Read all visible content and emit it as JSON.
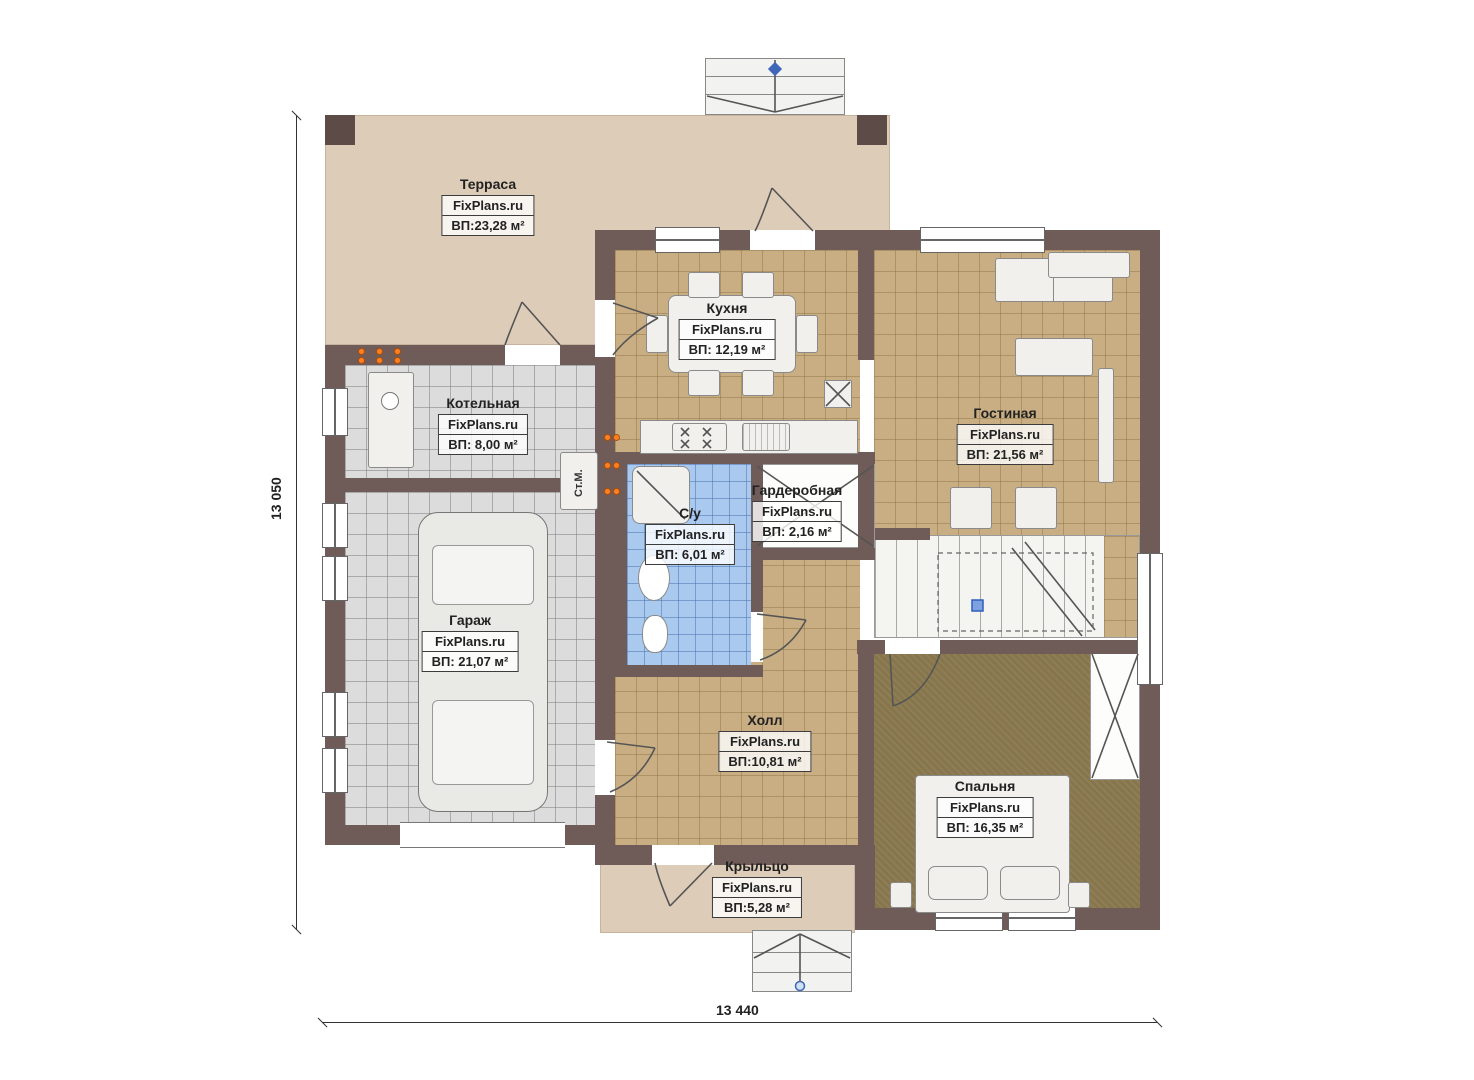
{
  "dims": {
    "height_label": "13 050",
    "width_label": "13 440"
  },
  "rooms": {
    "terrace": {
      "name": "Терраса",
      "brand": "FixPlans.ru",
      "area": "ВП:23,28 м²"
    },
    "kitchen": {
      "name": "Кухня",
      "brand": "FixPlans.ru",
      "area": "ВП: 12,19 м²"
    },
    "boiler": {
      "name": "Котельная",
      "brand": "FixPlans.ru",
      "area": "ВП: 8,00 м²"
    },
    "living": {
      "name": "Гостиная",
      "brand": "FixPlans.ru",
      "area": "ВП: 21,56 м²"
    },
    "wardrobe": {
      "name": "Гардеробная",
      "brand": "FixPlans.ru",
      "area": "ВП: 2,16 м²"
    },
    "bathroom": {
      "name": "С/у",
      "brand": "FixPlans.ru",
      "area": "ВП: 6,01 м²"
    },
    "garage": {
      "name": "Гараж",
      "brand": "FixPlans.ru",
      "area": "ВП: 21,07 м²"
    },
    "hall": {
      "name": "Холл",
      "brand": "FixPlans.ru",
      "area": "ВП:10,81 м²"
    },
    "bedroom": {
      "name": "Спальня",
      "brand": "FixPlans.ru",
      "area": "ВП: 16,35 м²"
    },
    "porch": {
      "name": "Крыльцо",
      "brand": "FixPlans.ru",
      "area": "ВП:5,28 м²"
    }
  },
  "annotations": {
    "washing_machine": "Ст.М."
  },
  "colors": {
    "wall": "#6f5b58",
    "terrace": "#ddccb8",
    "tile_tan": "#c9ae84",
    "tile_gray": "#dcdcdc",
    "tile_blue": "#a9c9ee",
    "bedroom_floor": "#87764c",
    "radiator": "#ff8126",
    "marker_blue": "#3f66b8"
  }
}
